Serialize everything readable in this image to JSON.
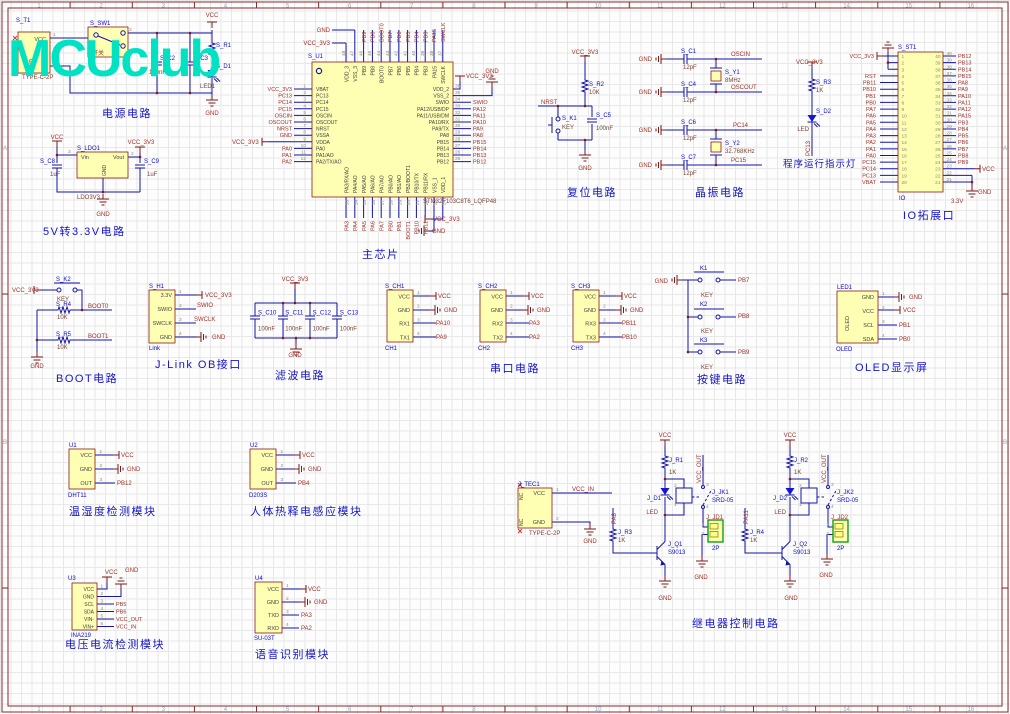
{
  "sheet": {
    "watermark": "MCUclub",
    "zone_numbers": [
      "1",
      "2",
      "3",
      "4",
      "5",
      "6",
      "7",
      "8",
      "9",
      "10",
      "11",
      "12",
      "13",
      "14",
      "15",
      "16"
    ],
    "zone_letters": [
      "A",
      "B",
      "C"
    ],
    "accent_color": "#00E2C2",
    "part_fill_color": "#FFFFB4",
    "wire_color": "#1515A8",
    "net_color": "#A03028"
  },
  "power": {
    "title": "电源电路",
    "t1": {
      "ref": "S_T1",
      "val": "TYPE-C-2P",
      "pin_vcc": "VCC",
      "pin_gnd": "GND",
      "n1": "1",
      "n2": "2"
    },
    "sw": {
      "ref": "S_SW1",
      "val": "开关",
      "n3": "3"
    },
    "c2": {
      "ref": "S_C2",
      "val": "100nF"
    },
    "c3": {
      "ref": "S_C3"
    },
    "r1": {
      "ref": "S_R1"
    },
    "d1": {
      "ref": "S_D1",
      "val": "LED1"
    },
    "vcc": "VCC",
    "gnd": "GND"
  },
  "ldo": {
    "title": "5V转3.3V电路",
    "ref": "S_LDO1",
    "val": "LDO3V3",
    "pin_vin": "Vin",
    "pin_vout": "Vout",
    "pin_gnd": "GND",
    "n3": "3",
    "n2": "2",
    "c8": {
      "ref": "S_C8",
      "val": "1uF"
    },
    "c9": {
      "ref": "S_C9",
      "val": "1uF"
    },
    "vcc": "VCC",
    "vcc3": "VCC_3V3",
    "gnd": "GND"
  },
  "mcu": {
    "title": "主芯片",
    "ref": "S_U1",
    "val": "STM32F103C8T6_LQFP48",
    "stub_vcc3": "VCC_3V3",
    "left_nums": [
      "1",
      "2",
      "3",
      "4",
      "5",
      "6",
      "7",
      "8",
      "9",
      "10",
      "11",
      "12"
    ],
    "left_names": [
      "VBAT",
      "PC13",
      "PC14",
      "PC15",
      "OSCIN",
      "OSCOUT",
      "NRST",
      "VSSA",
      "VDDA",
      "PA0",
      "PA1/AO",
      "PA2/TX/AO"
    ],
    "left_nets": [
      "VCC_3V3",
      "PC13",
      "PC14",
      "PC15",
      "OSCIN",
      "OSCOUT",
      "NRST",
      "GND",
      "",
      "PA0",
      "PA1",
      "PA2"
    ],
    "right_nums": [
      "36",
      "35",
      "34",
      "33",
      "32",
      "31",
      "30",
      "29",
      "28",
      "27",
      "26",
      "25"
    ],
    "right_names": [
      "VDD_2",
      "VSS_2",
      "SWIO",
      "PA12/USB/DP",
      "PA11/USB/DM",
      "PA10/RX",
      "PA9/TX",
      "PA8",
      "PB15",
      "PB14",
      "PB13",
      "PB12"
    ],
    "right_nets": [
      "",
      "",
      "SWIO",
      "PA12",
      "PA11",
      "PA10",
      "PA9",
      "PA8",
      "PB15",
      "PB14",
      "PB13",
      "PB12"
    ],
    "right_vcc3": "VCC_3V3",
    "right_gnd": "GND",
    "top_nums": [
      "48",
      "47",
      "46",
      "45",
      "44",
      "43",
      "42",
      "41",
      "40",
      "39",
      "38",
      "37"
    ],
    "top_names": [
      "VDD_3",
      "VSS_3",
      "PB9",
      "PB8",
      "BOOT0",
      "PB7",
      "PB6",
      "PB5",
      "PB4",
      "PB3",
      "PA15",
      "SWCLK"
    ],
    "top_nets": [
      "PB9",
      "PB8",
      "BOOT0",
      "PB7",
      "PB6",
      "PB5",
      "PB4",
      "PB3",
      "PA15",
      "SWCLK"
    ],
    "top_gnd": "GND",
    "top_vcc3": "VCC_3V3",
    "bottom_nums": [
      "13",
      "14",
      "15",
      "16",
      "17",
      "18",
      "19",
      "20",
      "21",
      "22",
      "23",
      "24"
    ],
    "bottom_names": [
      "PA3/RX/AO",
      "PA4/AO",
      "PA5/AO",
      "PA6/AO",
      "PA7/AO",
      "PB0/AO",
      "PB1/AO",
      "PB2/BOOT1",
      "PB10/TX",
      "PB11/RX",
      "VSS_1",
      "VDD_1"
    ],
    "bottom_nets": [
      "PA3",
      "PA4",
      "PA5",
      "PA6",
      "PA7",
      "PB0",
      "PB1",
      "BOOT1",
      "PB10",
      "PB11"
    ],
    "bottom_vcc3": "VCC_3V3",
    "bottom_gnd": "GND"
  },
  "reset": {
    "title": "复位电路",
    "vcc3": "VCC_3V3",
    "nrst": "NRST",
    "r2_ref": "S_R2",
    "r2_val": "10K",
    "k1_ref": "S_K1",
    "k1_val": "KEY",
    "c5_ref": "S_C5",
    "c5_val": "100nF",
    "gnd": "GND"
  },
  "xtal": {
    "title": "晶振电路",
    "gnd": "GND",
    "c1_ref": "S_C1",
    "c1_val": "12pF",
    "c4_ref": "S_C4",
    "c4_val": "12pF",
    "c6_ref": "S_C6",
    "c6_val": "12pF",
    "c7_ref": "S_C7",
    "c7_val": "12pF",
    "y1_ref": "S_Y1",
    "y1_val": "8MHz",
    "y2_ref": "S_Y2",
    "y2_val": "32.768KHz",
    "net1": "OSCIN",
    "net2": "OSCOUT",
    "net3": "PC14",
    "net4": "PC15"
  },
  "runled": {
    "title": "程序运行指示灯",
    "vcc3": "VCC_3V3",
    "r3_ref": "S_R3",
    "r3_val": "1K",
    "d2_ref": "S_D2",
    "d2_val": "LED",
    "net": "PC13"
  },
  "io": {
    "title": "IO拓展口",
    "ref": "S_ST1",
    "val": "IO",
    "vcc3": "VCC_3V3",
    "vcc": "VCC",
    "gnd": "GND",
    "v33": "3.3V",
    "left_nums": [
      "1",
      "2",
      "3",
      "4",
      "5",
      "6",
      "7",
      "8",
      "9",
      "10",
      "11",
      "12",
      "13",
      "14",
      "15",
      "16",
      "17",
      "18",
      "19",
      "20"
    ],
    "right_nums": [
      "40",
      "39",
      "38",
      "37",
      "36",
      "35",
      "34",
      "33",
      "32",
      "31",
      "30",
      "29",
      "28",
      "27",
      "26",
      "25",
      "24",
      "23",
      "22",
      "21"
    ],
    "left_nets": [
      "",
      "",
      "",
      "RST",
      "PB11",
      "PB10",
      "PB1",
      "PB0",
      "PA7",
      "PA6",
      "PA5",
      "PA4",
      "PA3",
      "PA2",
      "PA1",
      "PA0",
      "PC15",
      "PC14",
      "PC13",
      "VBAT"
    ],
    "right_nets": [
      "PB12",
      "PB13",
      "PB14",
      "PB15",
      "PA8",
      "PA9",
      "PA10",
      "PA11",
      "PA12",
      "PA15",
      "PB3",
      "PB4",
      "PB5",
      "PB6",
      "PB7",
      "PB8",
      "PB9"
    ]
  },
  "boot": {
    "title": "BOOT电路",
    "vcc3": "VCC_3V3",
    "k2_ref": "S_K2",
    "k2_val": "KEY",
    "r4_ref": "S_R4",
    "r4_val": "10K",
    "r5_ref": "S_R5",
    "r5_val": "10K",
    "boot0": "BOOT0",
    "boot1": "BOOT1",
    "gnd": "GND"
  },
  "jlink": {
    "title": "J-Link OB接口",
    "ref": "S_H1",
    "val": "Link",
    "names": [
      "3.3V",
      "SWIO",
      "SWCLK",
      "GND"
    ],
    "nums": [
      "1",
      "2",
      "3",
      "4"
    ],
    "net_vcc3": "VCC_3V3",
    "net_swio": "SWIO",
    "net_swclk": "SWCLK",
    "net_gnd": "GND"
  },
  "filter": {
    "title": "滤波电路",
    "vcc3": "VCC_3V3",
    "gnd": "GND",
    "refs": [
      "S_C10",
      "S_C11",
      "S_C12",
      "S_C13"
    ],
    "vals": [
      "100nF",
      "100nF",
      "100nF",
      "100nF"
    ]
  },
  "serial": {
    "title": "串口电路",
    "units": [
      {
        "ref": "S_CH1",
        "des": "CH1",
        "names": [
          "VCC",
          "GND",
          "RX1",
          "TX1"
        ],
        "nums": [
          "1",
          "2",
          "3",
          "4"
        ],
        "vcc": "VCC",
        "gnd": "GND",
        "rx": "PA10",
        "tx": "PA9"
      },
      {
        "ref": "S_CH2",
        "des": "CH2",
        "names": [
          "VCC",
          "GND",
          "RX2",
          "TX2"
        ],
        "nums": [
          "1",
          "2",
          "3",
          "4"
        ],
        "vcc": "VCC",
        "gnd": "GND",
        "rx": "PA3",
        "tx": "PA2"
      },
      {
        "ref": "S_CH3",
        "des": "CH3",
        "names": [
          "VCC",
          "GND",
          "RX3",
          "TX3"
        ],
        "nums": [
          "1",
          "2",
          "3",
          "4"
        ],
        "vcc": "VCC",
        "gnd": "GND",
        "rx": "PB11",
        "tx": "PB10"
      }
    ]
  },
  "keys": {
    "title": "按键电路",
    "gnd": "GND",
    "refs": [
      "K1",
      "K2",
      "K3"
    ],
    "vals": [
      "KEY",
      "KEY",
      "KEY"
    ],
    "nets": [
      "PB7",
      "PB8",
      "PB9"
    ]
  },
  "oled": {
    "title": "OLED显示屏",
    "ref": "LED1",
    "des": "OLED",
    "body": "OLED",
    "names": [
      "GND",
      "VCC",
      "SCL",
      "SDA"
    ],
    "nums": [
      "1",
      "2",
      "3",
      "4"
    ],
    "net_gnd": "GND",
    "net_vcc": "VCC",
    "net_scl": "PB1",
    "net_sda": "PB0"
  },
  "dht": {
    "title": "温湿度检测模块",
    "ref": "U1",
    "val": "DHT11",
    "names": [
      "VCC",
      "GND",
      "OUT"
    ],
    "nums": [
      "1",
      "2",
      "3"
    ],
    "net_vcc": "VCC",
    "net_gnd": "GND",
    "net_out": "PB12"
  },
  "pir": {
    "title": "人体热释电感应模块",
    "ref": "U2",
    "val": "D203S",
    "names": [
      "VCC",
      "GND",
      "OUT"
    ],
    "nums": [
      "1",
      "2",
      "3"
    ],
    "net_vcc": "VCC",
    "net_gnd": "GND",
    "net_out": "PB4"
  },
  "ina": {
    "title": "电压电流检测模块",
    "ref": "U3",
    "val": "INA219",
    "names": [
      "VCC",
      "GND",
      "SCL",
      "SDA",
      "VIN-",
      "VIN+"
    ],
    "nums": [
      "1",
      "2",
      "3",
      "4",
      "5",
      "6"
    ],
    "net_vcc": "VCC",
    "net_gnd": "GND",
    "nets": [
      "PB5",
      "PB6",
      "VCC_OUT",
      "VCC_IN"
    ]
  },
  "voice": {
    "title": "语音识别模块",
    "ref": "U4",
    "val": "SU-03T",
    "names": [
      "VCC",
      "GND",
      "TXD",
      "RXD"
    ],
    "nums": [
      "1",
      "2",
      "3",
      "4"
    ],
    "net_vcc": "VCC",
    "net_gnd": "GND",
    "net_tx": "PA3",
    "net_rx": "PA2"
  },
  "tec": {
    "ref": "J_TEC1",
    "val": "TYPE-C-2P",
    "nc": "NC",
    "pin_vcc": "VCC",
    "pin_gnd": "GND",
    "n1": "1",
    "n2": "2",
    "net": "VCC_IN",
    "gnd": "GND"
  },
  "relay": {
    "title": "继电器控制电路",
    "vcc": "VCC",
    "vcc_out": "VCC_OUT",
    "gnd": "GND",
    "u1": {
      "r_ref": "J_R1",
      "r_val": "1K",
      "d_ref": "J_D1",
      "d_val": "LED",
      "q_ref": "J_Q1",
      "q_val": "S9013",
      "rb_ref": "J_R3",
      "rb_val": "1K",
      "net": "PA8",
      "jk_ref": "J_JK1",
      "jk_val": "SRD-05",
      "jd_ref": "J_JD1",
      "jd_val": "2P",
      "n_coil_top": "2",
      "n_coil_bot": "1",
      "n_com": "3",
      "n_no": "4",
      "cn1": "1",
      "cn2": "2"
    },
    "u2": {
      "r_ref": "J_R2",
      "r_val": "1K",
      "d_ref": "J_D2",
      "d_val": "LED",
      "q_ref": "J_Q2",
      "q_val": "S9013",
      "rb_ref": "J_R4",
      "rb_val": "1K",
      "net": "PA11",
      "jk_ref": "J_JK2",
      "jk_val": "SRD-05",
      "jd_ref": "J_JD2",
      "jd_val": "2P",
      "n_coil_top": "2",
      "n_coil_bot": "1",
      "n_com": "3",
      "n_no": "4",
      "cn1": "1",
      "cn2": "2"
    }
  }
}
